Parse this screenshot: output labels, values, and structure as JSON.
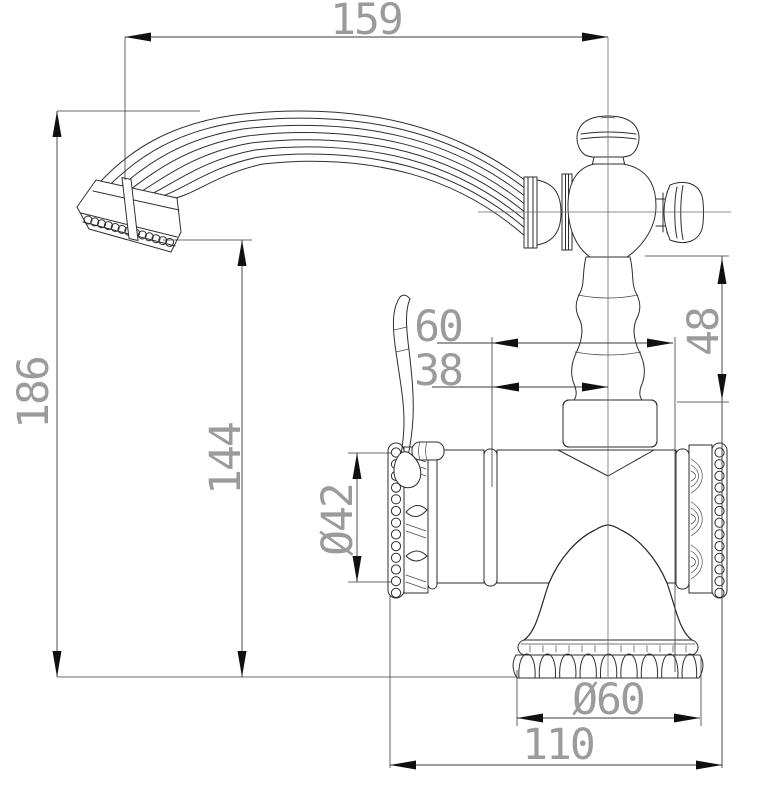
{
  "drawing": {
    "kind": "technical dimension drawing",
    "subject": "classic single-lever basin faucet, side elevation",
    "background": "#ffffff",
    "line_color": "#2e2e2e",
    "dim_text_color": "#9b9b9b"
  },
  "dimensions": {
    "spout_reach": {
      "value": "159",
      "orientation": "horizontal",
      "position": "top"
    },
    "overall_height": {
      "value": "186",
      "orientation": "vertical",
      "position": "far-left"
    },
    "spout_outlet_height": {
      "value": "144",
      "orientation": "vertical",
      "position": "left-inner"
    },
    "body_diameter": {
      "value": "Ø42",
      "orientation": "vertical",
      "position": "left-of-body"
    },
    "offset_upper": {
      "value": "60",
      "orientation": "horizontal",
      "position": "middle"
    },
    "offset_lower": {
      "value": "38",
      "orientation": "horizontal",
      "position": "middle"
    },
    "neck_height": {
      "value": "48",
      "orientation": "vertical",
      "position": "right"
    },
    "base_diameter": {
      "value": "Ø60",
      "orientation": "horizontal",
      "position": "bottom"
    },
    "base_span": {
      "value": "110",
      "orientation": "horizontal",
      "position": "bottom"
    }
  }
}
